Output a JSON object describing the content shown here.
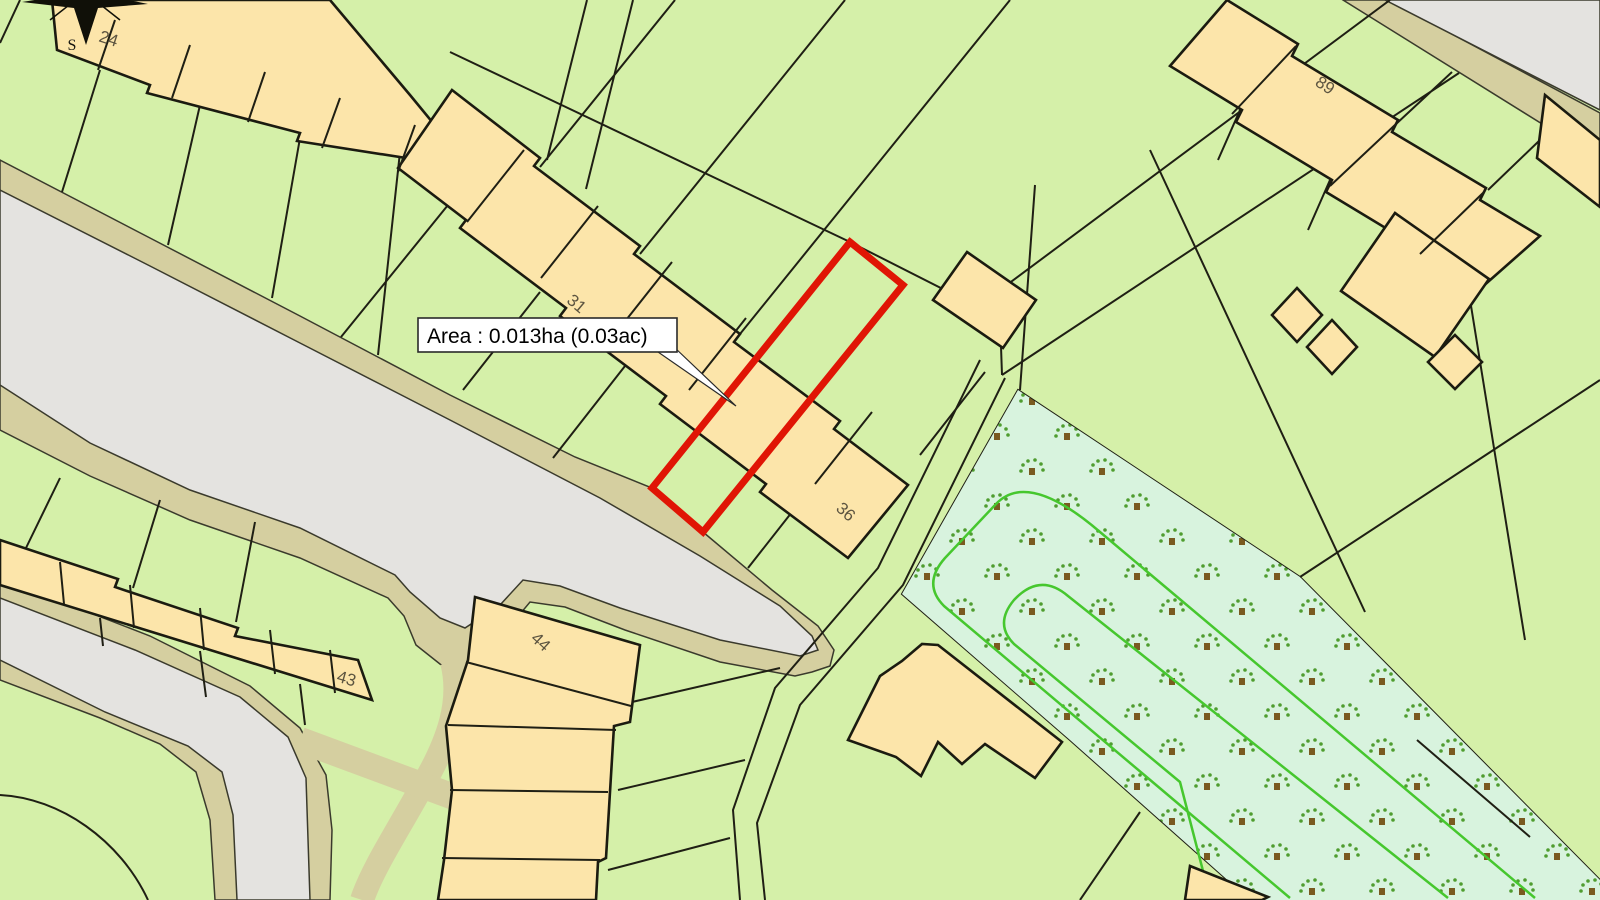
{
  "labels": {
    "plot24": "24",
    "plot31": "31",
    "plot36": "36",
    "plot43": "43",
    "plot44": "44",
    "plot89": "89"
  },
  "compass": {
    "south": "S"
  },
  "callout": {
    "area": "Area : 0.013ha (0.03ac)"
  },
  "highlight": {
    "outline_color": "#e01505"
  },
  "palette": {
    "parcel_green": "#d5f0a9",
    "building_tan": "#fce5aa",
    "road_gray": "#e4e3e0",
    "road_verge_khaki": "#d5cfa0",
    "orchard_mint": "#d8f3de",
    "orchard_path_green": "#46c72e",
    "boundary_dark": "#1f1f14",
    "label_olive": "#5c5440"
  }
}
